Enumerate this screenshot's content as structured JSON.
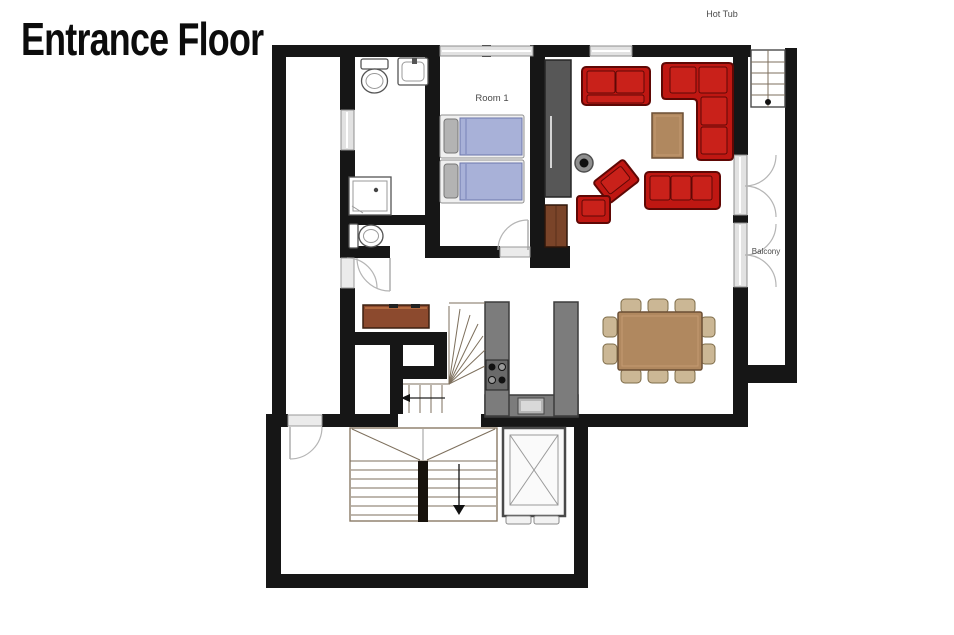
{
  "title": "Entrance Floor",
  "labels": {
    "hot_tub": "Hot Tub",
    "room_1": "Room 1",
    "balcony": "Balcony"
  },
  "colors": {
    "wall": "#161616",
    "sofa": "#bf1712",
    "sofa_dark": "#5f0805",
    "sofa_seat": "#c9211a",
    "bed": "#a8b1d8",
    "bed_dark": "#6b76ad",
    "bed_frame": "#f0f0f0",
    "pillow": "#b3b3b3",
    "wood": "#b0885f",
    "wood_dark": "#6b4f35",
    "wood_light": "#c49a72",
    "chair": "#cbb795",
    "chair_dark": "#7e6c49",
    "counter": "#7c7c7c",
    "counter_dark": "#3d3d3d",
    "wardrobe": "#575757",
    "sideboard": "#8c4a2e",
    "cabinet": "#7a4429",
    "glass": "#e2e2e2",
    "glass_stroke": "#8f8f8f",
    "door": "#ebebeb",
    "door_stroke": "#9a9a9a",
    "arc": "#b5b5b5",
    "stair": "#7d6f5c",
    "fixture": "#555555",
    "label": "#4a4a4a",
    "title": "#0c0c0c"
  }
}
